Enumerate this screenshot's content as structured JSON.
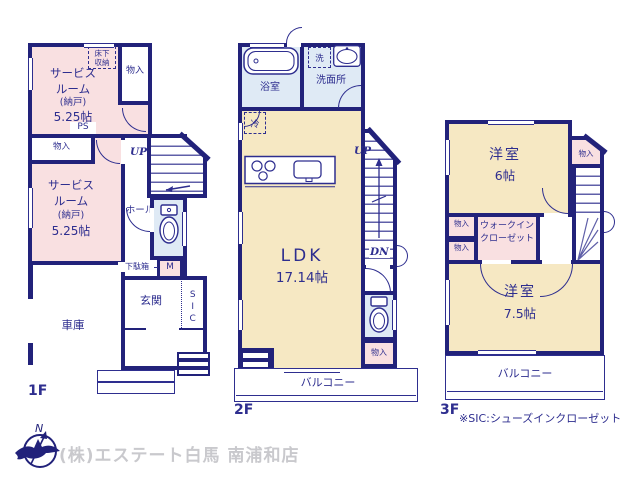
{
  "colors": {
    "wall": "#22227a",
    "ink": "#2e2e8f",
    "pink": "#f9e0e1",
    "cream": "#f6e8c3",
    "blue": "#dfeaf5",
    "gray_text": "#c9c9cd",
    "white": "#ffffff"
  },
  "floor1": {
    "label": "1F",
    "service_room_a": {
      "l1": "サービス",
      "l2": "ルーム",
      "l3": "(納戸)",
      "l4": "5.25帖"
    },
    "service_room_b": {
      "l1": "サービス",
      "l2": "ルーム",
      "l3": "(納戸)",
      "l4": "5.25帖"
    },
    "underfloor_storage": {
      "l1": "床下",
      "l2": "収納"
    },
    "closet_a": "物入",
    "closet_b": "物入",
    "ps": "PS",
    "up": "UP",
    "hall": "ホール",
    "shoe_box": "下駄箱",
    "meter": "M",
    "movable_shelf": "可動棚",
    "entrance": "玄関",
    "sic": "SIC",
    "garage": "車庫"
  },
  "floor2": {
    "label": "2F",
    "bath": "浴室",
    "washer": "洗",
    "washroom": "洗面所",
    "fridge": "冷",
    "up": "UP",
    "dn": "DN",
    "ldk_name": "LDK",
    "ldk_size": "17.14帖",
    "closet": "物入",
    "balcony": "バルコニー"
  },
  "floor3": {
    "label": "3F",
    "room_a_name": "洋室",
    "room_a_size": "6帖",
    "closet_a": "物入",
    "closet_b": "物入",
    "closet_c": "物入",
    "wic_l1": "ウォークイン",
    "wic_l2": "クローゼット",
    "dn": "DN",
    "room_b_name": "洋室",
    "room_b_size": "7.5帖",
    "balcony": "バルコニー"
  },
  "footer": {
    "note": "※SIC:シューズインクローゼット",
    "company": "(株)エステート白馬 南浦和店",
    "compass_n": "N"
  }
}
